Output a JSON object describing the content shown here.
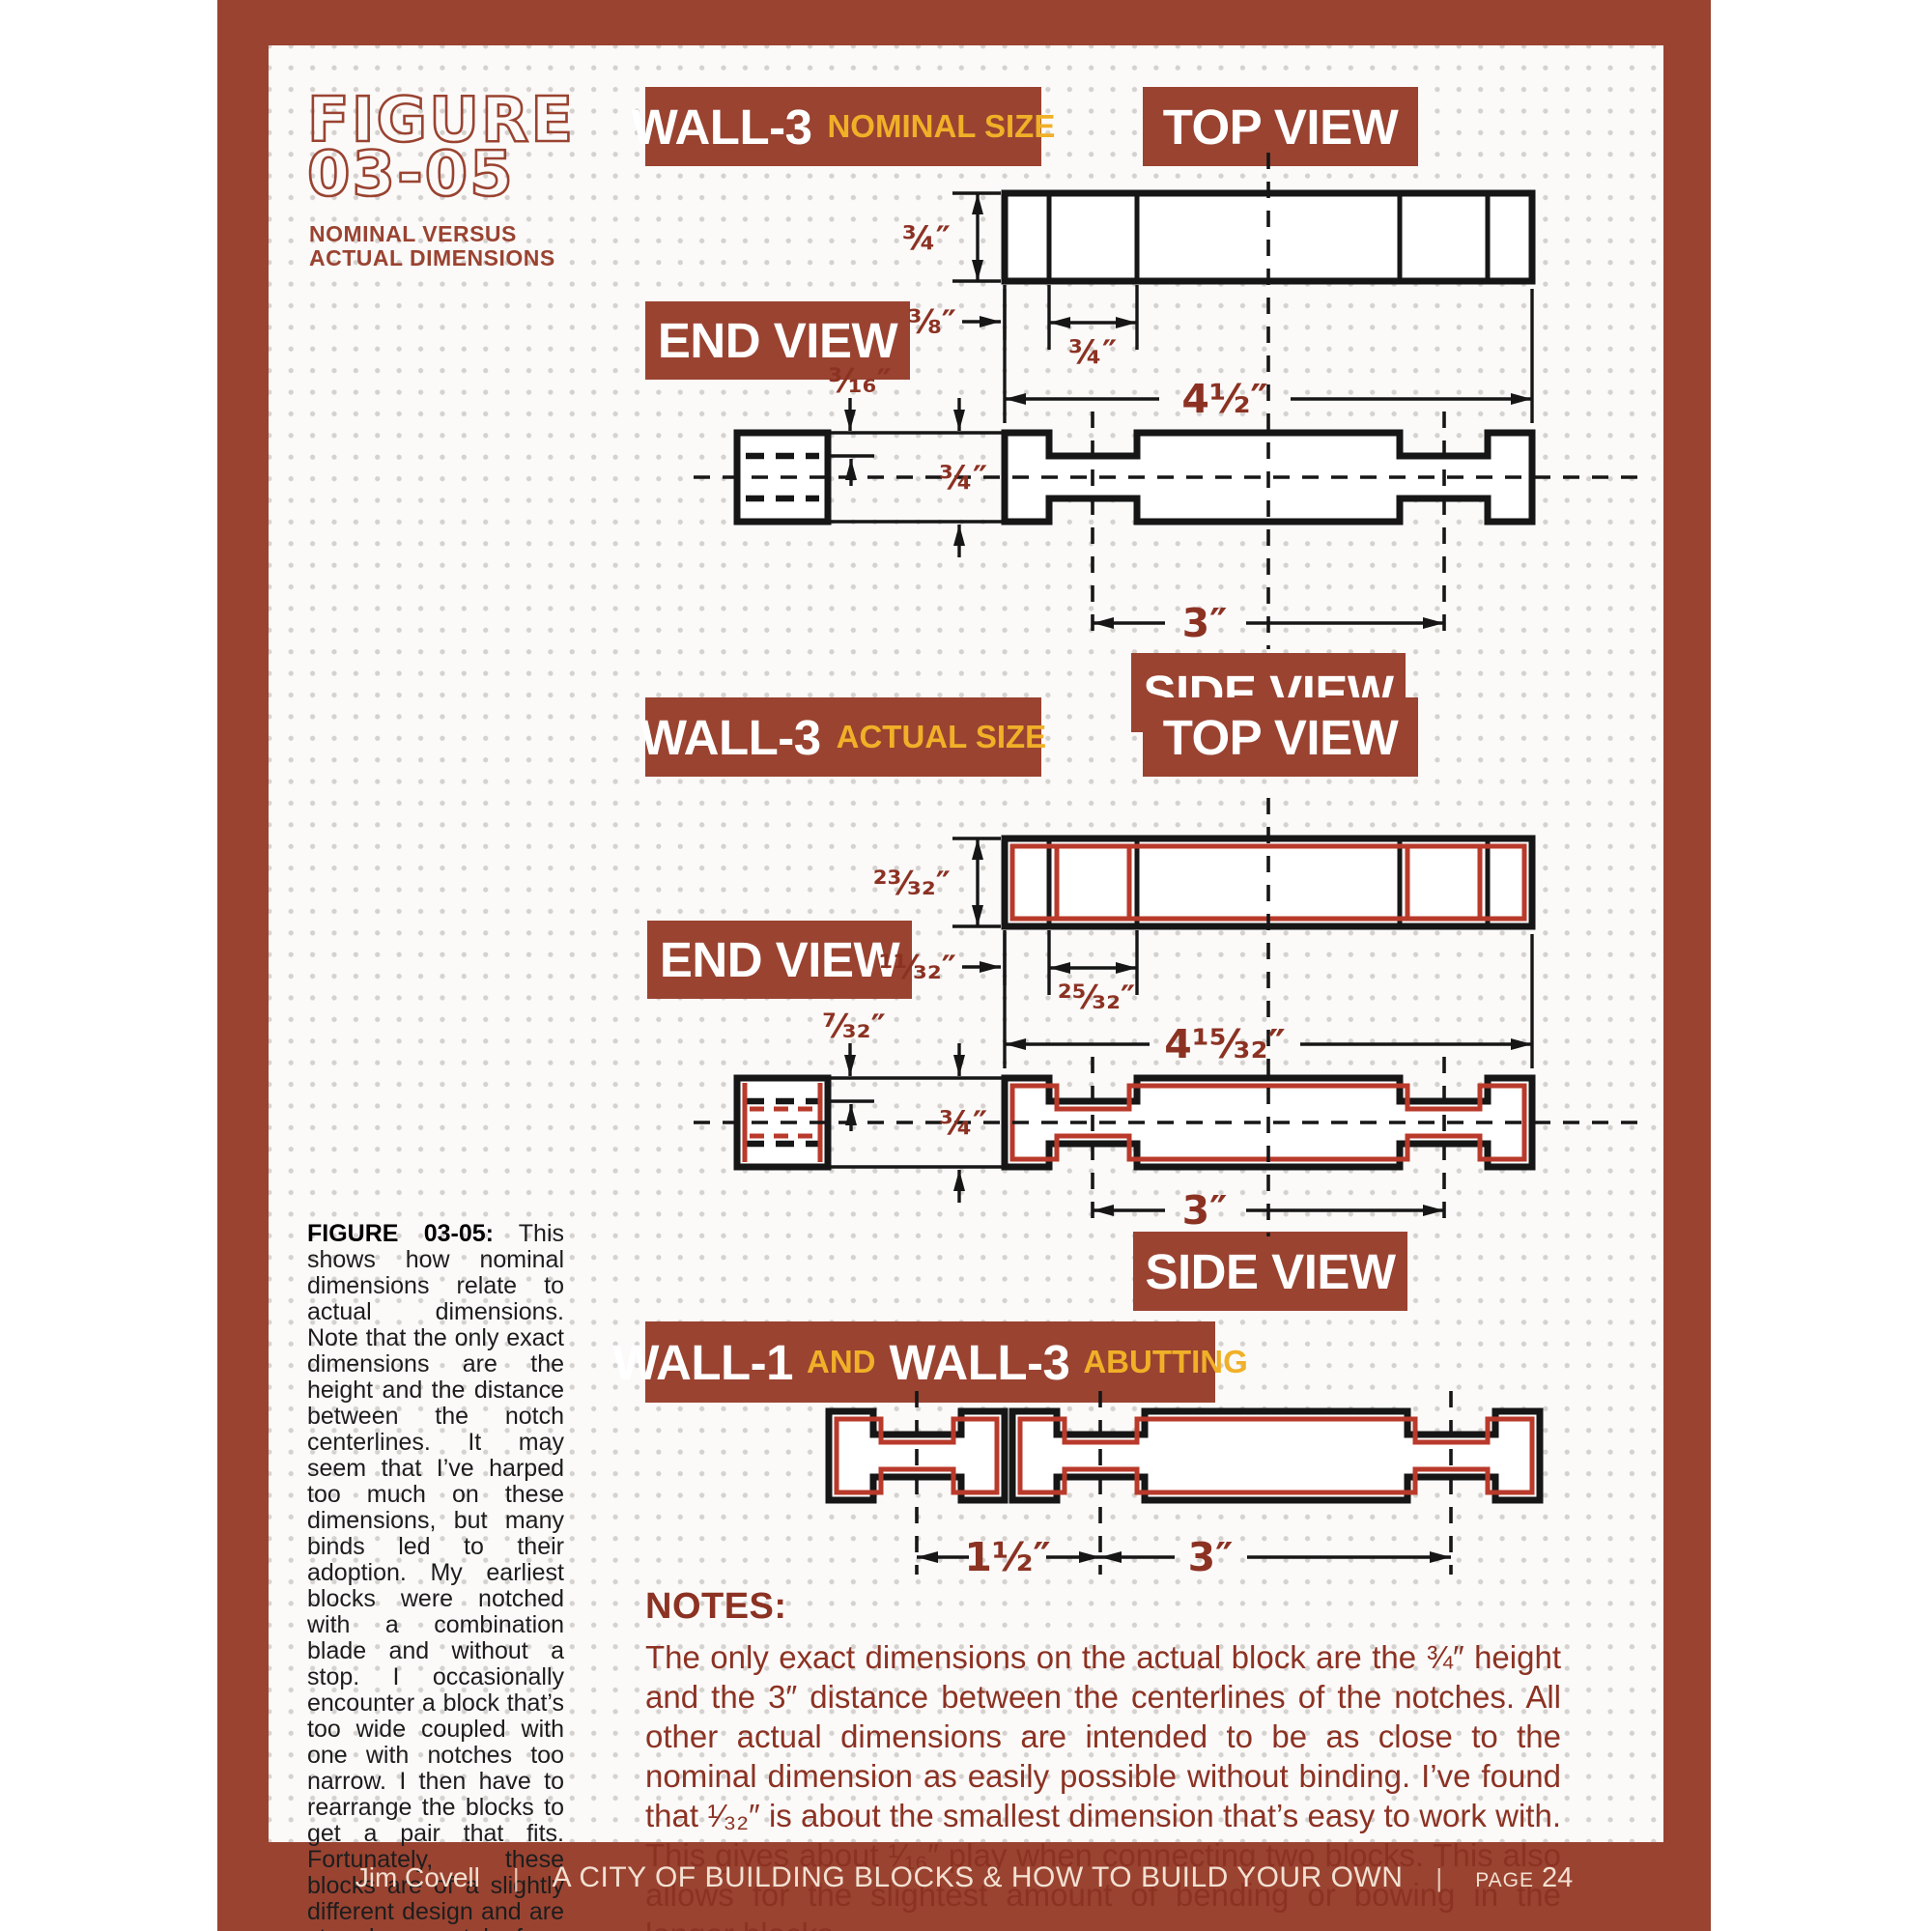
{
  "figure_title": {
    "line1": "FIGURE",
    "line2": "03-05",
    "subtitle1": "NOMINAL VERSUS",
    "subtitle2": "ACTUAL DIMENSIONS"
  },
  "headers": {
    "wall3_nominal": {
      "name": "WALL-3",
      "qualifier": "NOMINAL SIZE"
    },
    "wall3_actual": {
      "name": "WALL-3",
      "qualifier": "ACTUAL SIZE"
    },
    "top_view": "TOP VIEW",
    "end_view": "END VIEW",
    "side_view": "SIDE VIEW",
    "abutting": {
      "name1": "WALL-1",
      "conj": "AND",
      "name2": "WALL-3",
      "qualifier": "ABUTTING"
    }
  },
  "dimensions": {
    "nominal": {
      "height": "¾″",
      "edge_offset": "⅜″",
      "notch_width": "¾″",
      "overall_width": "4½″",
      "notch_depth": "³⁄₁₆″",
      "side_height": "¾″",
      "notch_spacing": "3″"
    },
    "actual": {
      "height": "²³⁄₃₂″",
      "edge_offset": "¹¹⁄₃₂″",
      "notch_width": "²⁵⁄₃₂″",
      "overall_width": "4¹⁵⁄₃₂″",
      "notch_depth": "⁷⁄₃₂″",
      "side_height": "¾″",
      "notch_spacing": "3″"
    },
    "abutting": {
      "offset": "1½″",
      "spacing": "3″"
    }
  },
  "caption": {
    "lead": "FIGURE 03-05:",
    "body": "This shows how nominal dimensions relate to actual dimensions. Note that the only exact dimensions are the height and the distance between the notch centerlines. It may seem that I’ve harped too much on these dimensions, but many binds led to their adoption. My earliest blocks were notched with a combination blade and without a stop. I occasionally encounter a block that’s too wide coupled with one with notches too narrow. I then have to rearrange the blocks to get a pair that fits. Fortunately, these blocks are of a slightly different design and are stored separately from the current blocks."
  },
  "notes": {
    "heading": "NOTES:",
    "body": "The only exact dimensions on the actual block are the ¾″ height and the 3″ distance between the centerlines of the notches. All other actual dimensions are intended to be as close to the nominal dimension as easily possible without binding. I’ve found that ¹⁄₃₂″ is about the smallest dimension that’s easy to work with. This gives about ¹⁄₁₆″ play when connecting two blocks. This also allows for the slightest amount of bending or bowing in the longer blocks."
  },
  "footer": {
    "author": "Jim Covell",
    "separator": "|",
    "book_title": "A CITY OF BUILDING BLOCKS & HOW TO BUILD YOUR OWN",
    "page_label": "PAGE",
    "page_number": "24"
  },
  "colors": {
    "frame_red": "#9a4331",
    "accent_yellow": "#f0b028",
    "dimension_text": "#8c3223",
    "overlay_red": "#b93a2b",
    "line_black": "#161616"
  }
}
